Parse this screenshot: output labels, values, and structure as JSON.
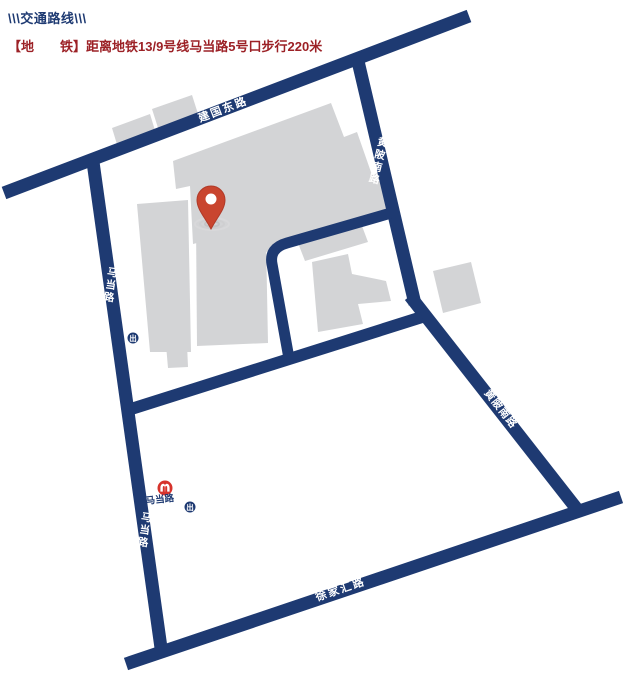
{
  "header": {
    "title": "\\\\\\交通路线\\\\\\",
    "subtitle": "【地　　铁】距离地铁13/9号线马当路5号口步行220米"
  },
  "colors": {
    "road": "#1e3a72",
    "building": "#d3d4d6",
    "header_title": "#1e3a72",
    "header_subtitle": "#9c2126",
    "pin": "#c9452f",
    "metro_logo": "#d6332c",
    "ripple": "#c8c8ca",
    "road_label_text": "#ffffff"
  },
  "roads": {
    "jianguo_east": {
      "label": "建国东路"
    },
    "huangpi_south_upper": {
      "label": "黄陂南路"
    },
    "huangpi_south_lower": {
      "label": "黄陂南路"
    },
    "madang_upper": {
      "label": "马当路"
    },
    "madang_lower": {
      "label": "马当路"
    },
    "xujiahui": {
      "label": "徐家汇路"
    }
  },
  "station": {
    "name": "马当路",
    "exit_label": "出"
  }
}
